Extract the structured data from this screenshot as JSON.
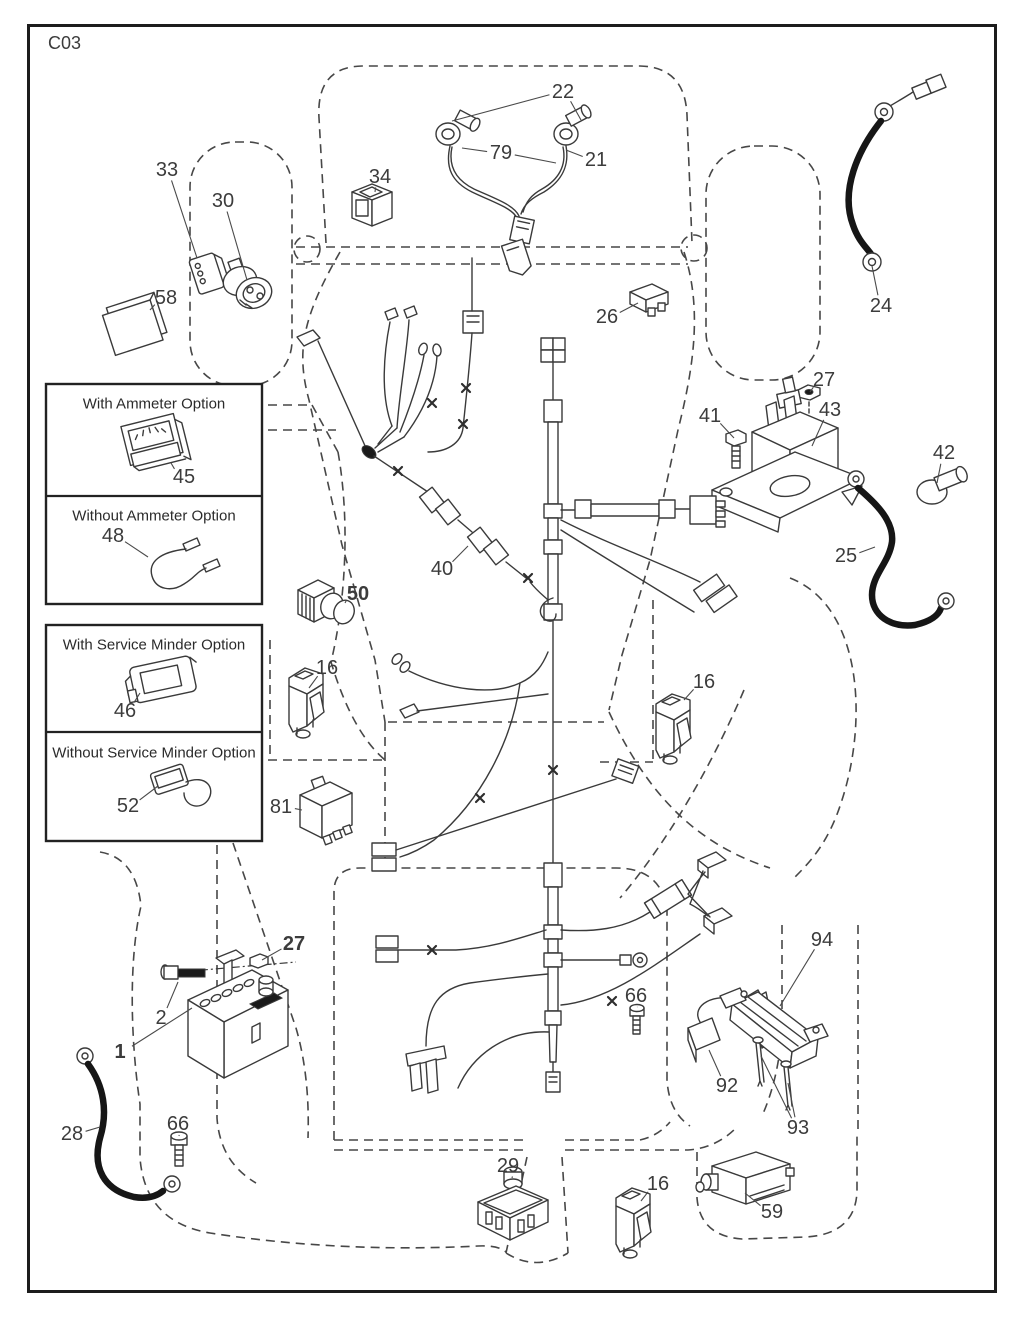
{
  "page": {
    "code": "C03"
  },
  "colors": {
    "line": "#3a3a3a",
    "cable": "#161616",
    "background": "#ffffff"
  },
  "option_boxes": [
    {
      "sections": [
        {
          "title": "With Ammeter Option"
        },
        {
          "title": "Without Ammeter Option"
        }
      ]
    },
    {
      "sections": [
        {
          "title": "With Service Minder Option"
        },
        {
          "title": "Without Service Minder Option"
        }
      ]
    }
  ],
  "callouts": [
    {
      "label": "22",
      "x": 563,
      "y": 92,
      "targets": [
        [
          452,
          121
        ],
        [
          581,
          120
        ]
      ]
    },
    {
      "label": "79",
      "x": 501,
      "y": 153,
      "targets": [
        [
          462,
          148
        ],
        [
          556,
          163
        ]
      ]
    },
    {
      "label": "21",
      "x": 596,
      "y": 160,
      "targets": [
        [
          566,
          150
        ]
      ]
    },
    {
      "label": "34",
      "x": 380,
      "y": 177,
      "targets": [
        [
          375,
          192
        ]
      ]
    },
    {
      "label": "33",
      "x": 167,
      "y": 170,
      "targets": [
        [
          197,
          258
        ]
      ]
    },
    {
      "label": "30",
      "x": 223,
      "y": 201,
      "targets": [
        [
          247,
          280
        ]
      ]
    },
    {
      "label": "58",
      "x": 166,
      "y": 298,
      "targets": [
        [
          150,
          310
        ]
      ]
    },
    {
      "label": "26",
      "x": 607,
      "y": 317,
      "targets": [
        [
          638,
          303
        ]
      ]
    },
    {
      "label": "24",
      "x": 881,
      "y": 306,
      "targets": [
        [
          872,
          266
        ]
      ]
    },
    {
      "label": "27",
      "x": 824,
      "y": 380,
      "targets": [
        [
          810,
          392
        ]
      ]
    },
    {
      "label": "41",
      "x": 710,
      "y": 416,
      "targets": [
        [
          734,
          438
        ]
      ]
    },
    {
      "label": "43",
      "x": 830,
      "y": 410,
      "targets": [
        [
          812,
          446
        ]
      ]
    },
    {
      "label": "42",
      "x": 944,
      "y": 453,
      "targets": [
        [
          937,
          483
        ]
      ]
    },
    {
      "label": "25",
      "x": 846,
      "y": 556,
      "targets": [
        [
          875,
          547
        ]
      ]
    },
    {
      "label": "45",
      "x": 184,
      "y": 477,
      "targets": [
        [
          171,
          463
        ]
      ]
    },
    {
      "label": "48",
      "x": 113,
      "y": 536,
      "targets": [
        [
          148,
          557
        ]
      ]
    },
    {
      "label": "46",
      "x": 125,
      "y": 711,
      "targets": [
        [
          140,
          693
        ]
      ]
    },
    {
      "label": "52",
      "x": 128,
      "y": 806,
      "targets": [
        [
          158,
          786
        ]
      ]
    },
    {
      "label": "40",
      "x": 442,
      "y": 569,
      "targets": [
        [
          468,
          546
        ]
      ]
    },
    {
      "label": "50",
      "x": 358,
      "y": 594,
      "bold": true,
      "targets": [
        [
          345,
          603
        ]
      ]
    },
    {
      "label": "16",
      "x": 327,
      "y": 668,
      "targets": [
        [
          309,
          688
        ]
      ]
    },
    {
      "label": "16",
      "x": 704,
      "y": 682,
      "targets": [
        [
          684,
          700
        ]
      ]
    },
    {
      "label": "81",
      "x": 281,
      "y": 807,
      "targets": [
        [
          302,
          810
        ]
      ]
    },
    {
      "label": "27",
      "x": 294,
      "y": 944,
      "bold": true,
      "targets": [
        [
          262,
          960
        ]
      ]
    },
    {
      "label": "2",
      "x": 161,
      "y": 1018,
      "targets": [
        [
          178,
          982
        ]
      ]
    },
    {
      "label": "1",
      "x": 120,
      "y": 1052,
      "bold": true,
      "targets": [
        [
          192,
          1008
        ]
      ]
    },
    {
      "label": "28",
      "x": 72,
      "y": 1134,
      "targets": [
        [
          100,
          1127
        ]
      ]
    },
    {
      "label": "66",
      "x": 178,
      "y": 1124,
      "targets": [
        [
          179,
          1136
        ]
      ]
    },
    {
      "label": "66",
      "x": 636,
      "y": 996,
      "targets": [
        [
          637,
          1007
        ]
      ]
    },
    {
      "label": "29",
      "x": 508,
      "y": 1166,
      "targets": [
        [
          512,
          1178
        ]
      ]
    },
    {
      "label": "16",
      "x": 658,
      "y": 1184,
      "targets": [
        [
          641,
          1201
        ]
      ]
    },
    {
      "label": "92",
      "x": 727,
      "y": 1086,
      "targets": [
        [
          709,
          1050
        ]
      ]
    },
    {
      "label": "93",
      "x": 798,
      "y": 1128,
      "targets": [
        [
          761,
          1056
        ],
        [
          788,
          1083
        ]
      ]
    },
    {
      "label": "94",
      "x": 822,
      "y": 940,
      "targets": [
        [
          780,
          1006
        ]
      ]
    },
    {
      "label": "59",
      "x": 772,
      "y": 1212,
      "targets": [
        [
          745,
          1193
        ]
      ]
    }
  ]
}
